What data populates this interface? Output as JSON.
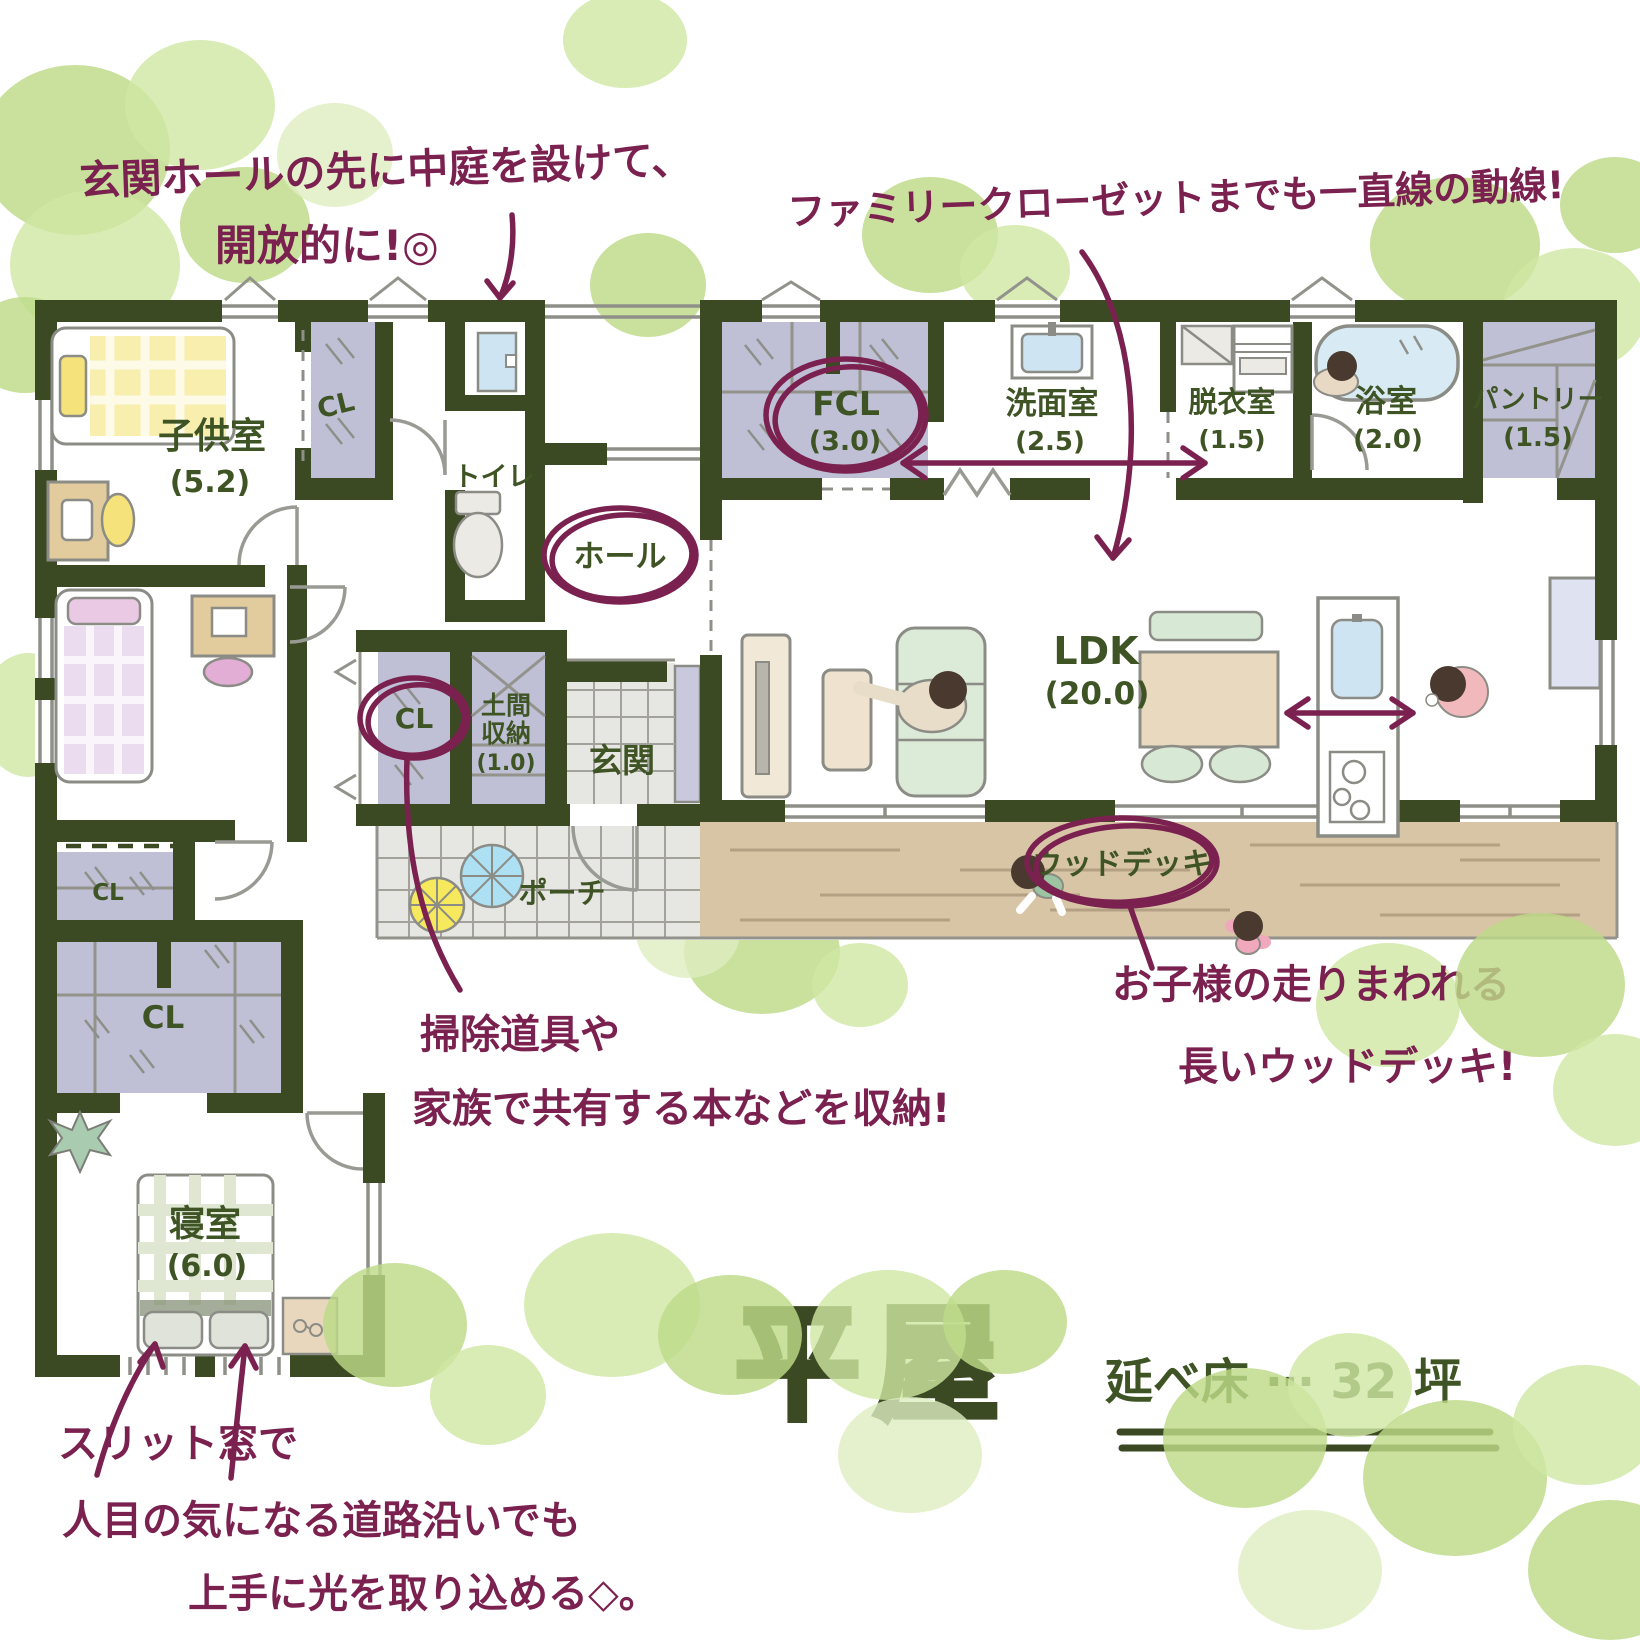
{
  "title": {
    "name": "平屋",
    "floor_area": "延べ床 ⋯ 32 坪"
  },
  "annotations": {
    "courtyard": {
      "line1": "玄関ホールの先に中庭を設けて、",
      "line2": "開放的に!◎"
    },
    "family_closet": {
      "line1": "ファミリークローゼットまでも一直線の動線!"
    },
    "storage": {
      "line1": "掃除道具や",
      "line2": "家族で共有する本などを収納!"
    },
    "deck": {
      "line1": "お子様の走りまわれる",
      "line2": "長いウッドデッキ!"
    },
    "slit_window": {
      "line1": "スリット窓で",
      "line2": "人目の気になる道路沿いでも",
      "line3": "上手に光を取り込める◇。"
    }
  },
  "rooms": {
    "kids1": {
      "name": "子供室",
      "size": "(5.2)"
    },
    "kids2": {
      "name": "子供室",
      "size": "(5.2)"
    },
    "cl1": {
      "name": "CL"
    },
    "toilet": {
      "name": "トイレ"
    },
    "fcl": {
      "name": "FCL",
      "size": "(3.0)"
    },
    "washroom": {
      "name": "洗面室",
      "size": "(2.5)"
    },
    "dressing": {
      "name": "脱衣室",
      "size": "(1.5)"
    },
    "bath": {
      "name": "浴室",
      "size": "(2.0)"
    },
    "pantry": {
      "name": "パントリー",
      "size": "(1.5)"
    },
    "hall": {
      "name": "ホール"
    },
    "ldk": {
      "name": "LDK",
      "size": "(20.0)"
    },
    "doma": {
      "line1": "土間",
      "line2": "収納",
      "size": "(1.0)"
    },
    "genkan": {
      "name": "玄関"
    },
    "cl2": {
      "name": "CL"
    },
    "porch": {
      "name": "ポーチ"
    },
    "deck": {
      "name": "ウッドデッキ"
    },
    "cl3": {
      "name": "CL"
    },
    "cl4": {
      "name": "CL"
    },
    "bedroom": {
      "name": "寝室",
      "size": "(6.0)"
    }
  },
  "colors": {
    "wall": "#3b4a23",
    "label_green": "#3f5424",
    "annotation_plum": "#7b2150",
    "tree_green": "#bddb88",
    "closet_purple": "#bfc0d5",
    "deck_tan": "#d8c5a6",
    "tile_gray": "#e6e6e2"
  }
}
